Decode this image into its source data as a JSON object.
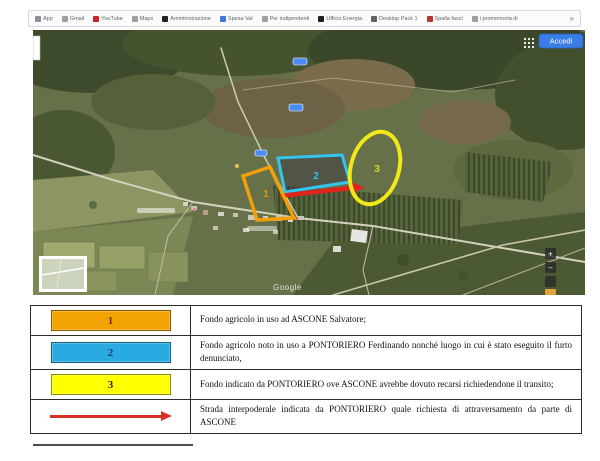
{
  "bookmarks_bar": {
    "items": [
      {
        "label": "App",
        "icon": "apps-grid-icon",
        "icon_color": "#8a8f98"
      },
      {
        "label": "Gmail",
        "icon": "gmail-icon",
        "icon_color": "#9aa0a6"
      },
      {
        "label": "YouTube",
        "icon": "youtube-icon",
        "icon_color": "#cc2127"
      },
      {
        "label": "Maps",
        "icon": "maps-icon",
        "icon_color": "#9aa0a6"
      },
      {
        "label": "Amministrazione",
        "icon": "letter-icon",
        "icon_color": "#202124"
      },
      {
        "label": "Spesa Val",
        "icon": "doc-icon",
        "icon_color": "#3b78dd"
      },
      {
        "label": "Per indipendenti",
        "icon": "doc-icon",
        "icon_color": "#9aa0a6"
      },
      {
        "label": "Ufficio Energia",
        "icon": "letter-icon",
        "icon_color": "#202124"
      },
      {
        "label": "Desktop Pack 1",
        "icon": "doc-icon",
        "icon_color": "#5f6368"
      },
      {
        "label": "Spalla fasci",
        "icon": "doc-icon",
        "icon_color": "#b0392e"
      },
      {
        "label": "i promemoria di",
        "icon": "plus-icon",
        "icon_color": "#9aa0a6"
      }
    ],
    "overflow_chevron": "»"
  },
  "map": {
    "signin_button": "Accedi",
    "watermark": "Google",
    "zoom_in": "+",
    "zoom_out": "−",
    "overlay_labels": {
      "area1": "1",
      "area2": "2",
      "area3": "3"
    },
    "colors": {
      "area1_stroke": "#f2a007",
      "area2_stroke": "#35c4f0",
      "area3_stroke": "#f0e818",
      "arrow": "#e0241c",
      "signin_bg": "#3a7de8"
    }
  },
  "legend_table": {
    "rows": [
      {
        "symbol": "1",
        "symbol_type": "swatch",
        "symbol_color": "#f2a202",
        "symbol_text_color": "#7b3000",
        "description": "Fondo agricolo in uso ad ASCONE Salvatore;"
      },
      {
        "symbol": "2",
        "symbol_type": "swatch",
        "symbol_color": "#29abe2",
        "symbol_text_color": "#17375e",
        "description": "Fondo agricolo noto in uso a PONTORIERO Ferdinando nonché luogo in cui è stato eseguito il furto denunciato,"
      },
      {
        "symbol": "3",
        "symbol_type": "swatch",
        "symbol_color": "#ffff00",
        "symbol_text_color": "#222222",
        "description": "Fondo indicato da PONTORIERO ove ASCONE avrebbe dovuto recarsi richiedendone il transito;"
      },
      {
        "symbol": "→",
        "symbol_type": "arrow",
        "symbol_color": "#d93025",
        "symbol_text_color": "#d93025",
        "description": "Strada interpoderale indicata da PONTORIERO quale richiesta di attraversamento da parte di ASCONE"
      }
    ]
  }
}
